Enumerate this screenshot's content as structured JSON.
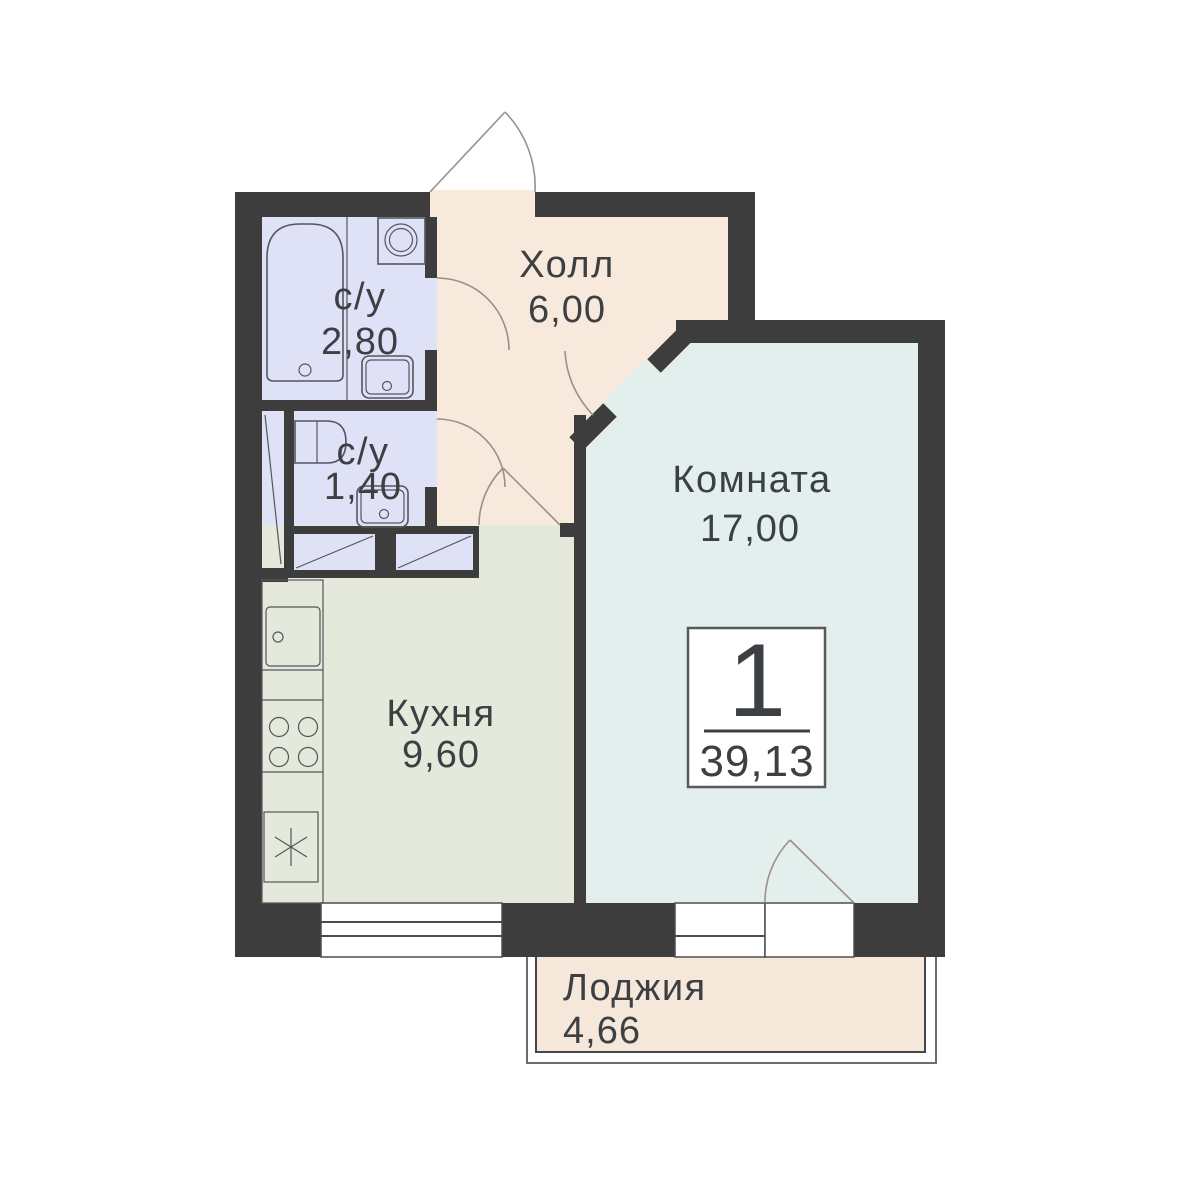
{
  "plan": {
    "title": "apartment-floor-plan",
    "badge": {
      "rooms_count": "1",
      "total_area": "39,13"
    },
    "rooms": [
      {
        "id": "hall",
        "name": "Холл",
        "area": "6,00"
      },
      {
        "id": "bathroom-big",
        "name": "с/у",
        "area": "2,80"
      },
      {
        "id": "bathroom-small",
        "name": "с/у",
        "area": "1,40"
      },
      {
        "id": "kitchen",
        "name": "Кухня",
        "area": "9,60"
      },
      {
        "id": "living-room",
        "name": "Комната",
        "area": "17,00"
      },
      {
        "id": "loggia",
        "name": "Лоджия",
        "area": "4,66"
      }
    ],
    "fixtures": [
      "bathtub",
      "washing-machine",
      "sink",
      "toilet",
      "kitchen-sink",
      "stove-hob",
      "fridge",
      "wardrobe-box",
      "shaft",
      "window",
      "door-swing"
    ],
    "colors": {
      "wall": "#3d3d3d",
      "hall": "#f8e9dd",
      "bathroom": "#dfe2f7",
      "kitchen": "#e4e9db",
      "room": "#e3efec",
      "loggia": "#f6e7db",
      "text": "#3c4043",
      "white": "#ffffff"
    }
  }
}
